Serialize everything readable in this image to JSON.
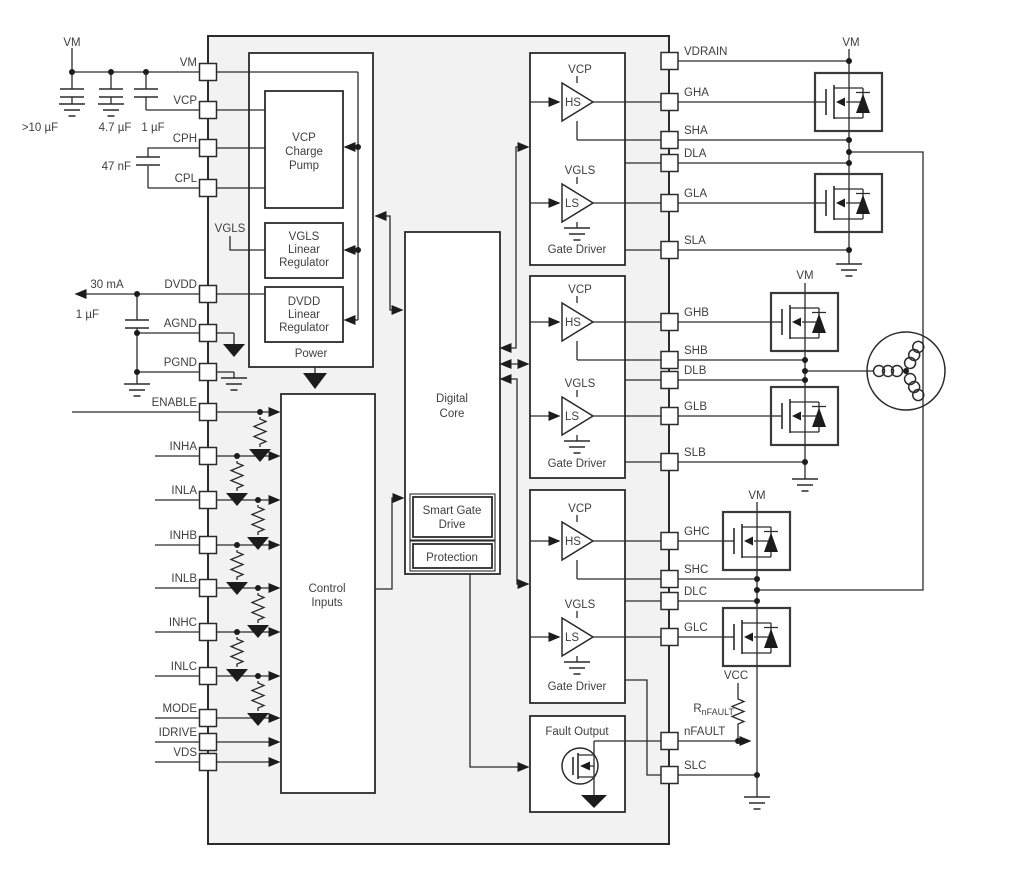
{
  "pins_left": [
    "VM",
    "VCP",
    "CPH",
    "CPL",
    "DVDD",
    "AGND",
    "PGND",
    "ENABLE",
    "INHA",
    "INLA",
    "INHB",
    "INLB",
    "INHC",
    "INLC",
    "MODE",
    "IDRIVE",
    "VDS"
  ],
  "pins_right": [
    "VDRAIN",
    "GHA",
    "SHA",
    "DLA",
    "GLA",
    "SLA",
    "GHB",
    "SHB",
    "DLB",
    "GLB",
    "SLB",
    "GHC",
    "SHC",
    "DLC",
    "GLC",
    "nFAULT",
    "SLC"
  ],
  "external": {
    "vm_top_left": "VM",
    "cap_bulk": ">10 µF",
    "cap_4u7": "4.7 µF",
    "cap_1u": "1 µF",
    "cap_cp": "47 nF",
    "dvdd_current": "30 mA",
    "cap_dvdd": "1 µF",
    "vm_a": "VM",
    "vm_b": "VM",
    "vm_c": "VM",
    "vcc": "VCC",
    "rnfault_prefix": "R",
    "rnfault_sub": "nFAULT"
  },
  "blocks": {
    "power": "Power",
    "charge_pump": {
      "l1": "VCP",
      "l2": "Charge",
      "l3": "Pump"
    },
    "vgls_reg": {
      "l1": "VGLS",
      "l2": "Linear",
      "l3": "Regulator"
    },
    "dvdd_reg": {
      "l1": "DVDD",
      "l2": "Linear",
      "l3": "Regulator"
    },
    "vgls_node": "VGLS",
    "control_inputs": {
      "l1": "Control",
      "l2": "Inputs"
    },
    "digital_core": {
      "l1": "Digital",
      "l2": "Core"
    },
    "smart_gate_drive": {
      "l1": "Smart Gate",
      "l2": "Drive"
    },
    "protection": "Protection",
    "gate_driver": "Gate Driver",
    "fault_output": "Fault Output",
    "vcp": "VCP",
    "vgls": "VGLS",
    "hs": "HS",
    "ls": "LS"
  },
  "colors": {
    "chip_fill": "#f2f2f2",
    "line": "#2b2b2b",
    "text": "#3f3f3f"
  }
}
